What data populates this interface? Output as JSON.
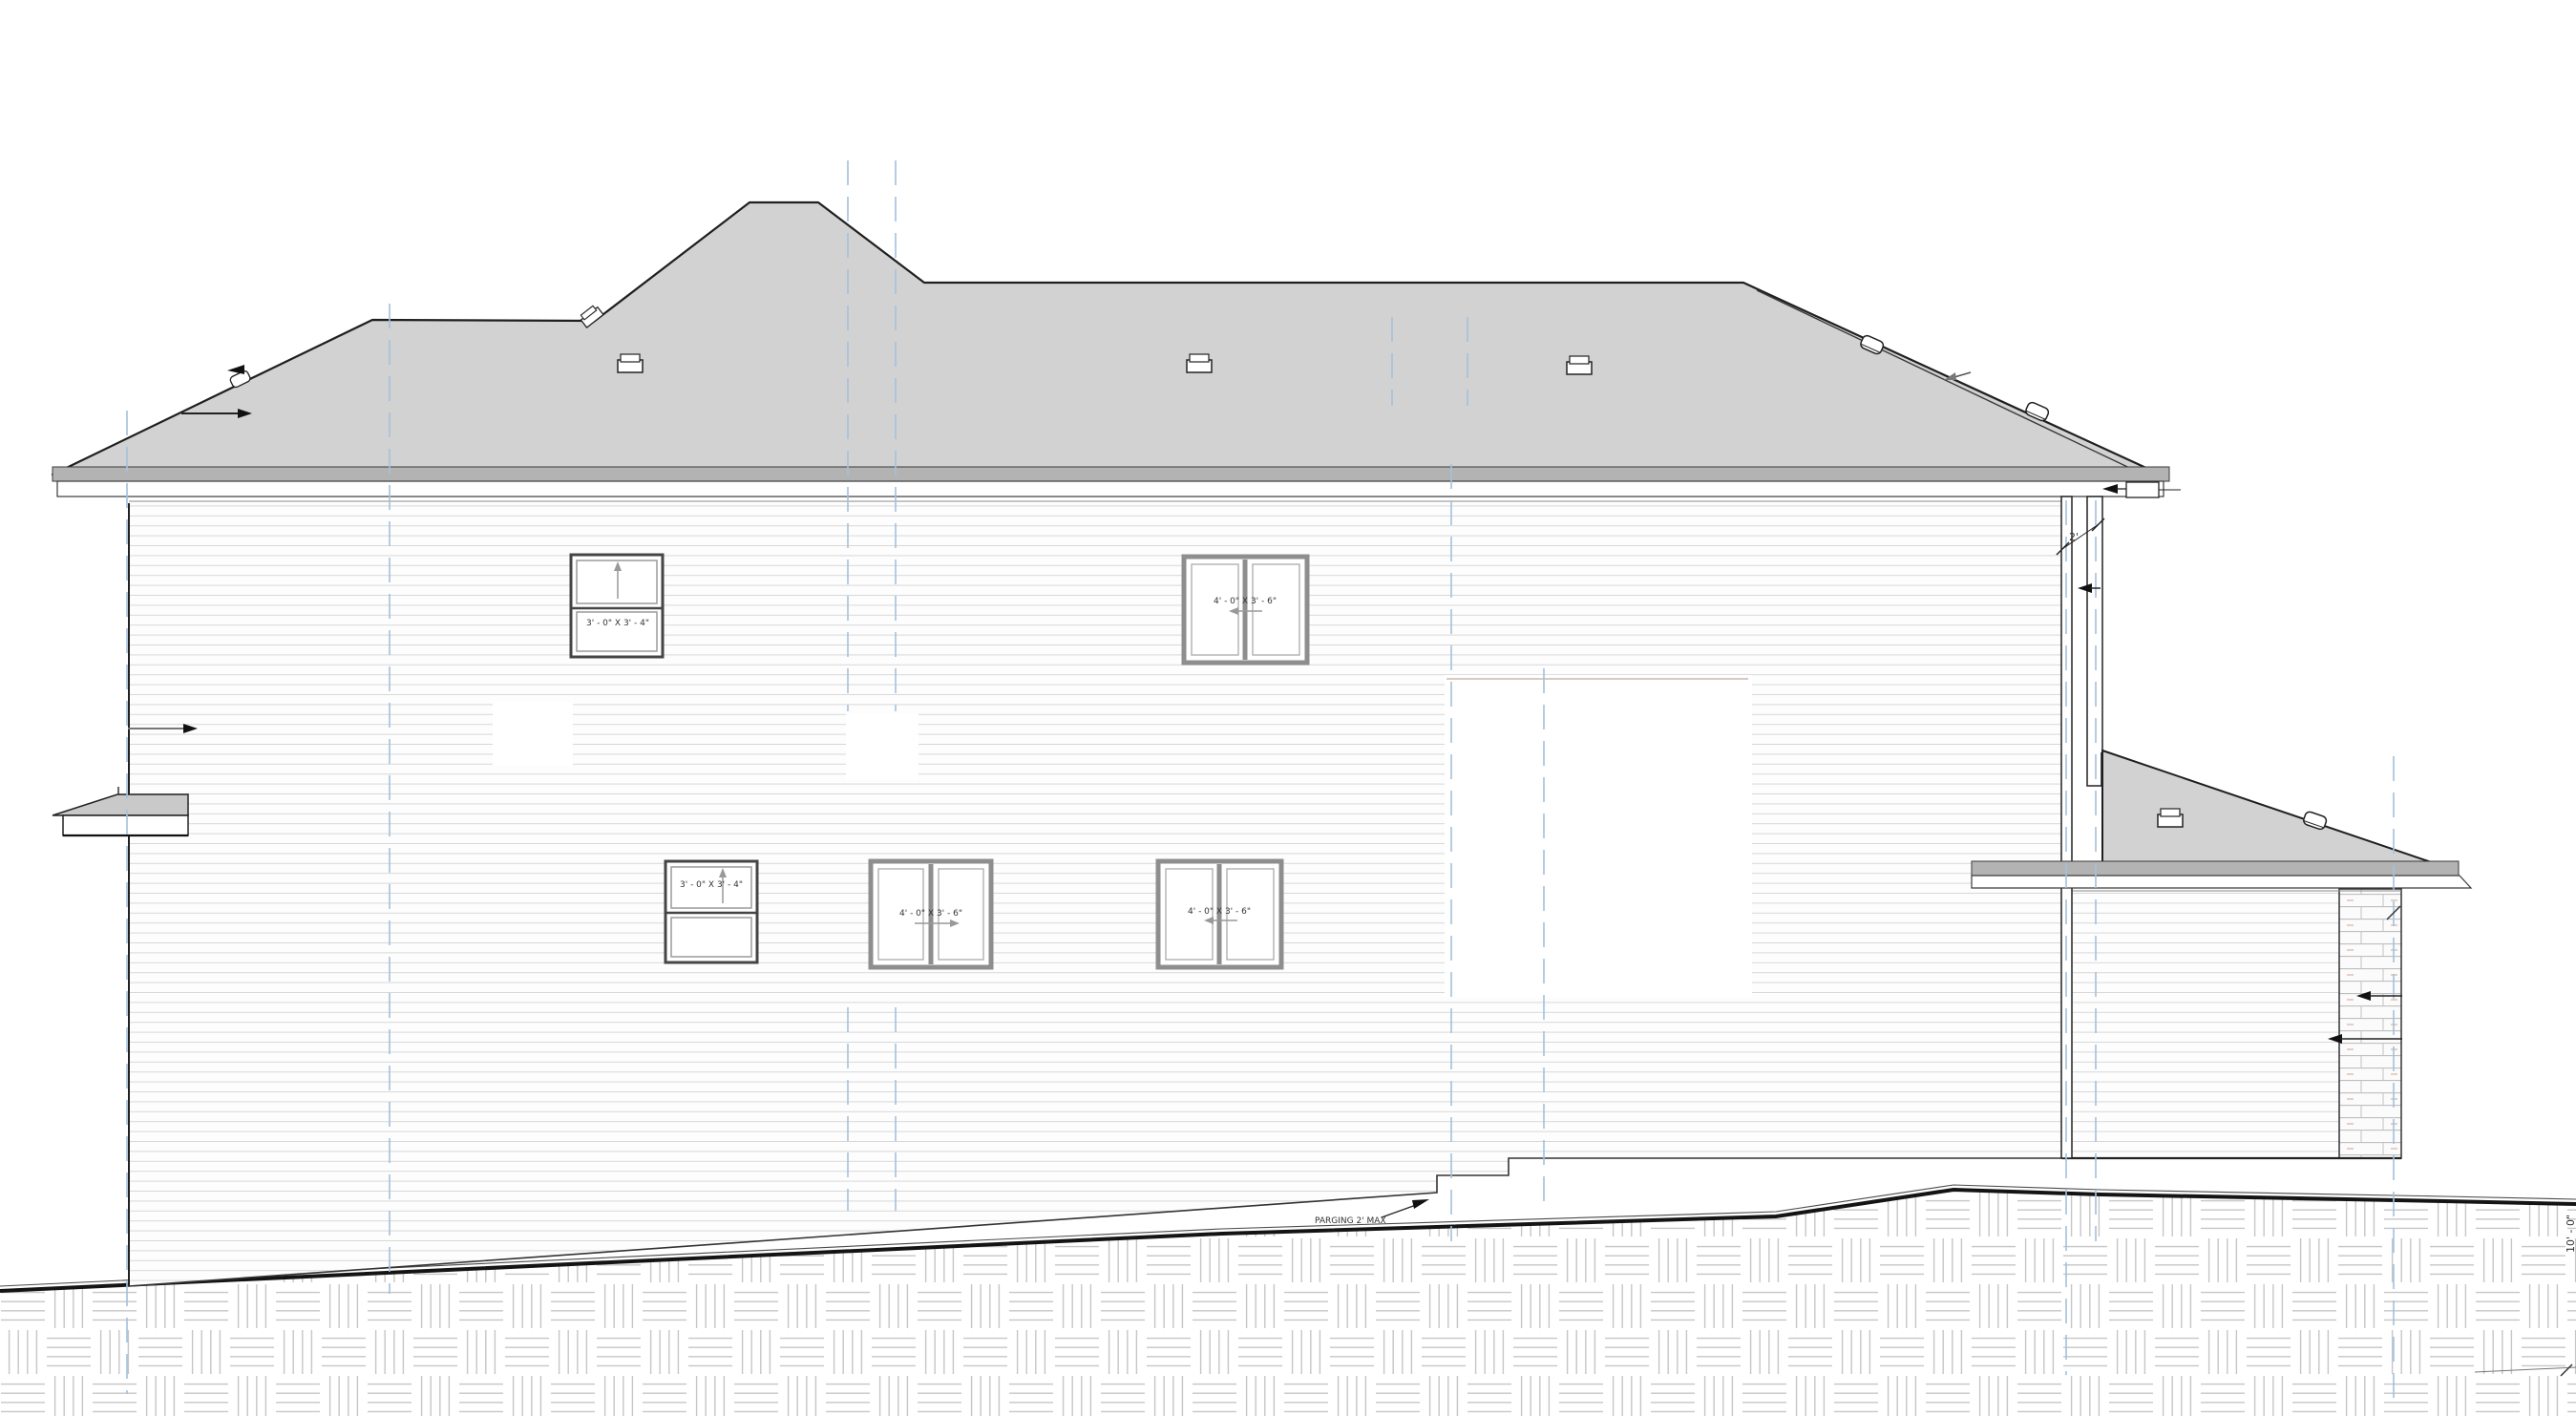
{
  "annotations": {
    "parging_note": "PARGING 2' MAX",
    "roof_offset_dim": "2'",
    "grade_elevation": "10' - 0\""
  },
  "windows": [
    {
      "id": "upper-left",
      "style": "single-hung",
      "label": "3' - 0\" X 3' - 4\""
    },
    {
      "id": "upper-middle",
      "style": "horizontal-slider",
      "label": "4' - 0\" X 3' - 6\""
    },
    {
      "id": "lower-left",
      "style": "single-hung",
      "label": "3' - 0\" X 3' - 4\""
    },
    {
      "id": "lower-middle",
      "style": "horizontal-slider",
      "label": "4' - 0\" X 3' - 6\""
    },
    {
      "id": "lower-right",
      "style": "horizontal-slider",
      "label": "4' - 0\" X 3' - 6\""
    }
  ],
  "icons": [
    "roof-box-vent",
    "roof-stack-vent",
    "keynote-box",
    "leader-arrow",
    "sash-slide-arrow",
    "sash-lift-arrow",
    "grade-hatch",
    "reference-grid-line"
  ],
  "colors": {
    "roof_fill": "#d2d2d2",
    "gutter_band": "#b3b3b3",
    "outline": "#1f1f1f",
    "siding_line": "#d8d8d8",
    "grid_blue": "#a4c0dc",
    "ground_hatch": "#c6c6c6",
    "brick_line": "#b8b8b8",
    "brick_accent": "#c79a85",
    "hung_frame": "#454545",
    "slider_frame": "#8e8e8e",
    "text": "#333333",
    "arrow": "#111111"
  }
}
